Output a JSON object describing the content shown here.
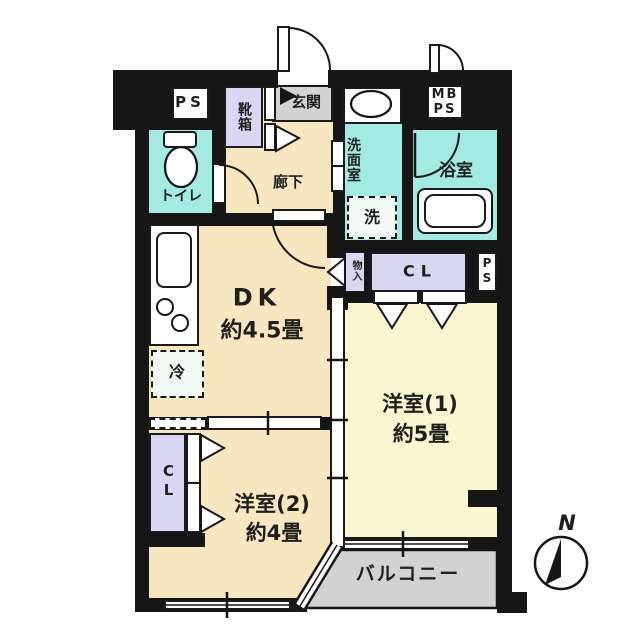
{
  "plan_type": "apartment-floor-plan",
  "rooms": {
    "dk": {
      "name": "DK",
      "size": "約4.5畳"
    },
    "western1": {
      "name": "洋室(1)",
      "size": "約5畳"
    },
    "western2": {
      "name": "洋室(2)",
      "size": "約4畳"
    },
    "corridor": "廊下",
    "entrance": "玄関",
    "toilet": "トイレ",
    "washroom": "洗面室",
    "bathroom": "浴室",
    "balcony": "バルコニー"
  },
  "fixtures": {
    "shoe_box": "靴箱",
    "pipe_space_top": "PS",
    "meter_box_line1": "MB",
    "meter_box_line2": "PS",
    "pipe_space_right": "PS",
    "closet_main": "CL",
    "closet_west2": "CL",
    "storage": "物入",
    "refrigerator": "冷",
    "washer": "洗"
  },
  "compass": {
    "north_label": "N"
  },
  "colors": {
    "room_cream": "#F7E7C1",
    "room_pale_yellow": "#FAF6D2",
    "wet_area_cyan": "#A3EAE3",
    "closet_lavender": "#D8D6F2",
    "entrance_balcony_gray": "#D2D2D2",
    "wall_black": "#161616"
  }
}
